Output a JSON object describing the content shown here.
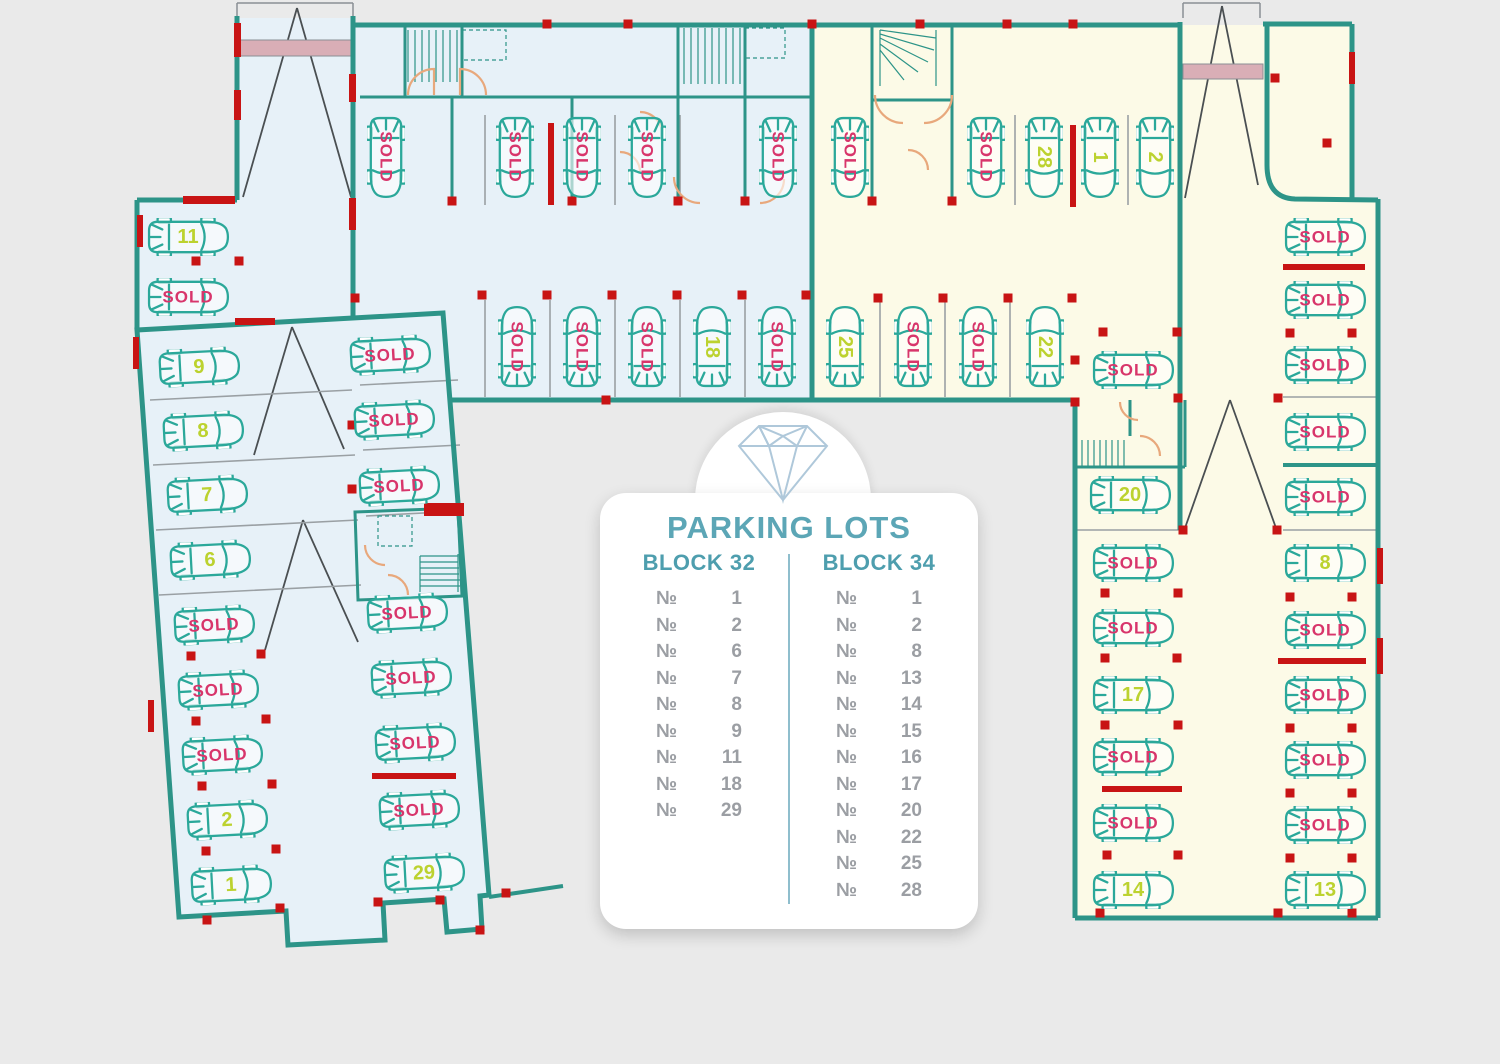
{
  "panel": {
    "logo_icon": "diamond-icon",
    "title": "PARKING LOTS",
    "numero_symbol": "№",
    "columns": [
      {
        "header": "BLOCK 32",
        "items": [
          "1",
          "2",
          "6",
          "7",
          "8",
          "9",
          "11",
          "18",
          "29"
        ]
      },
      {
        "header": "BLOCK 34",
        "items": [
          "1",
          "2",
          "8",
          "13",
          "14",
          "15",
          "16",
          "17",
          "20",
          "22",
          "25",
          "28"
        ]
      }
    ]
  },
  "labels": {
    "sold": "SOLD"
  },
  "colors": {
    "background": "#eaeaea",
    "block32_floor": "#e7f1f8",
    "block34_floor": "#fcfae7",
    "wall_teal": "#2d9488",
    "red": "#c81414",
    "pink_band": "#d9aeb6",
    "car_outline": "#2ba89a",
    "sold_text": "#d8356b",
    "number_text": "#bcd22f",
    "panel_title": "#5ca6b6",
    "panel_header": "#4e9eae",
    "panel_list": "#9b9ea3"
  },
  "cars": [
    {
      "block": 32,
      "x": 188,
      "y": 237,
      "a": 0,
      "label": "11",
      "sold": false
    },
    {
      "block": 32,
      "x": 188,
      "y": 297,
      "a": 0,
      "label": "SOLD",
      "sold": true
    },
    {
      "block": 32,
      "x": 199,
      "y": 367,
      "a": -3,
      "label": "9",
      "sold": false
    },
    {
      "block": 32,
      "x": 203,
      "y": 431,
      "a": -3,
      "label": "8",
      "sold": false
    },
    {
      "block": 32,
      "x": 207,
      "y": 495,
      "a": -3,
      "label": "7",
      "sold": false
    },
    {
      "block": 32,
      "x": 210,
      "y": 560,
      "a": -3,
      "label": "6",
      "sold": false
    },
    {
      "block": 32,
      "x": 214,
      "y": 625,
      "a": -3,
      "label": "SOLD",
      "sold": true
    },
    {
      "block": 32,
      "x": 218,
      "y": 690,
      "a": -3,
      "label": "SOLD",
      "sold": true
    },
    {
      "block": 32,
      "x": 222,
      "y": 755,
      "a": -3,
      "label": "SOLD",
      "sold": true
    },
    {
      "block": 32,
      "x": 227,
      "y": 820,
      "a": -3,
      "label": "2",
      "sold": false
    },
    {
      "block": 32,
      "x": 231,
      "y": 885,
      "a": -3,
      "label": "1",
      "sold": false
    },
    {
      "block": 32,
      "x": 390,
      "y": 355,
      "a": -3,
      "label": "SOLD",
      "sold": true
    },
    {
      "block": 32,
      "x": 394,
      "y": 420,
      "a": -3,
      "label": "SOLD",
      "sold": true
    },
    {
      "block": 32,
      "x": 399,
      "y": 486,
      "a": -3,
      "label": "SOLD",
      "sold": true
    },
    {
      "block": 32,
      "x": 407,
      "y": 613,
      "a": -3,
      "label": "SOLD",
      "sold": true
    },
    {
      "block": 32,
      "x": 411,
      "y": 678,
      "a": -3,
      "label": "SOLD",
      "sold": true
    },
    {
      "block": 32,
      "x": 415,
      "y": 743,
      "a": -3,
      "label": "SOLD",
      "sold": true
    },
    {
      "block": 32,
      "x": 419,
      "y": 810,
      "a": -3,
      "label": "SOLD",
      "sold": true
    },
    {
      "block": 32,
      "x": 424,
      "y": 873,
      "a": -3,
      "label": "29",
      "sold": false
    },
    {
      "block": 32,
      "x": 386,
      "y": 157,
      "a": 90,
      "label": "SOLD",
      "sold": true
    },
    {
      "block": 32,
      "x": 515,
      "y": 157,
      "a": 90,
      "label": "SOLD",
      "sold": true
    },
    {
      "block": 32,
      "x": 582,
      "y": 157,
      "a": 90,
      "label": "SOLD",
      "sold": true
    },
    {
      "block": 32,
      "x": 647,
      "y": 157,
      "a": 90,
      "label": "SOLD",
      "sold": true
    },
    {
      "block": 32,
      "x": 778,
      "y": 157,
      "a": 90,
      "label": "SOLD",
      "sold": true
    },
    {
      "block": 32,
      "x": 517,
      "y": 347,
      "a": -90,
      "label": "SOLD",
      "sold": true
    },
    {
      "block": 32,
      "x": 582,
      "y": 347,
      "a": -90,
      "label": "SOLD",
      "sold": true
    },
    {
      "block": 32,
      "x": 647,
      "y": 347,
      "a": -90,
      "label": "SOLD",
      "sold": true
    },
    {
      "block": 32,
      "x": 712,
      "y": 347,
      "a": -90,
      "label": "18",
      "sold": false
    },
    {
      "block": 32,
      "x": 777,
      "y": 347,
      "a": -90,
      "label": "SOLD",
      "sold": true
    },
    {
      "block": 34,
      "x": 850,
      "y": 157,
      "a": 90,
      "label": "SOLD",
      "sold": true
    },
    {
      "block": 34,
      "x": 986,
      "y": 157,
      "a": 90,
      "label": "SOLD",
      "sold": true
    },
    {
      "block": 34,
      "x": 1044,
      "y": 157,
      "a": 90,
      "label": "28",
      "sold": false
    },
    {
      "block": 34,
      "x": 1100,
      "y": 157,
      "a": 90,
      "label": "1",
      "sold": false
    },
    {
      "block": 34,
      "x": 1155,
      "y": 157,
      "a": 90,
      "label": "2",
      "sold": false
    },
    {
      "block": 34,
      "x": 845,
      "y": 347,
      "a": -90,
      "label": "25",
      "sold": false
    },
    {
      "block": 34,
      "x": 913,
      "y": 347,
      "a": -90,
      "label": "SOLD",
      "sold": true
    },
    {
      "block": 34,
      "x": 978,
      "y": 347,
      "a": -90,
      "label": "SOLD",
      "sold": true
    },
    {
      "block": 34,
      "x": 1045,
      "y": 347,
      "a": -90,
      "label": "22",
      "sold": false
    },
    {
      "block": 34,
      "x": 1133,
      "y": 370,
      "a": 0,
      "label": "SOLD",
      "sold": true
    },
    {
      "block": 34,
      "x": 1130,
      "y": 495,
      "a": 0,
      "label": "20",
      "sold": false
    },
    {
      "block": 34,
      "x": 1133,
      "y": 563,
      "a": 0,
      "label": "SOLD",
      "sold": true
    },
    {
      "block": 34,
      "x": 1133,
      "y": 628,
      "a": 0,
      "label": "SOLD",
      "sold": true
    },
    {
      "block": 34,
      "x": 1133,
      "y": 695,
      "a": 0,
      "label": "17",
      "sold": false
    },
    {
      "block": 34,
      "x": 1133,
      "y": 757,
      "a": 0,
      "label": "SOLD",
      "sold": true
    },
    {
      "block": 34,
      "x": 1133,
      "y": 823,
      "a": 0,
      "label": "SOLD",
      "sold": true
    },
    {
      "block": 34,
      "x": 1133,
      "y": 890,
      "a": 0,
      "label": "14",
      "sold": false
    },
    {
      "block": 34,
      "x": 1325,
      "y": 237,
      "a": 0,
      "label": "SOLD",
      "sold": true
    },
    {
      "block": 34,
      "x": 1325,
      "y": 300,
      "a": 0,
      "label": "SOLD",
      "sold": true
    },
    {
      "block": 34,
      "x": 1325,
      "y": 365,
      "a": 0,
      "label": "SOLD",
      "sold": true
    },
    {
      "block": 34,
      "x": 1325,
      "y": 432,
      "a": 0,
      "label": "SOLD",
      "sold": true
    },
    {
      "block": 34,
      "x": 1325,
      "y": 497,
      "a": 0,
      "label": "SOLD",
      "sold": true
    },
    {
      "block": 34,
      "x": 1325,
      "y": 563,
      "a": 0,
      "label": "8",
      "sold": false
    },
    {
      "block": 34,
      "x": 1325,
      "y": 630,
      "a": 0,
      "label": "SOLD",
      "sold": true
    },
    {
      "block": 34,
      "x": 1325,
      "y": 695,
      "a": 0,
      "label": "SOLD",
      "sold": true
    },
    {
      "block": 34,
      "x": 1325,
      "y": 760,
      "a": 0,
      "label": "SOLD",
      "sold": true
    },
    {
      "block": 34,
      "x": 1325,
      "y": 825,
      "a": 0,
      "label": "SOLD",
      "sold": true
    },
    {
      "block": 34,
      "x": 1325,
      "y": 890,
      "a": 0,
      "label": "13",
      "sold": false
    }
  ],
  "marks": {
    "dots": [
      [
        196,
        261
      ],
      [
        239,
        261
      ],
      [
        355,
        298
      ],
      [
        547,
        24
      ],
      [
        628,
        24
      ],
      [
        812,
        24
      ],
      [
        920,
        24
      ],
      [
        1007,
        24
      ],
      [
        1073,
        24
      ],
      [
        452,
        201
      ],
      [
        572,
        201
      ],
      [
        678,
        201
      ],
      [
        745,
        201
      ],
      [
        872,
        201
      ],
      [
        952,
        201
      ],
      [
        482,
        295
      ],
      [
        547,
        295
      ],
      [
        612,
        295
      ],
      [
        677,
        295
      ],
      [
        742,
        295
      ],
      [
        806,
        295
      ],
      [
        878,
        298
      ],
      [
        943,
        298
      ],
      [
        1008,
        298
      ],
      [
        1072,
        298
      ],
      [
        606,
        400
      ],
      [
        1275,
        78
      ],
      [
        1327,
        143
      ],
      [
        1178,
        398
      ],
      [
        1278,
        398
      ],
      [
        1183,
        530
      ],
      [
        1277,
        530
      ],
      [
        1103,
        332
      ],
      [
        1177,
        332
      ],
      [
        1105,
        593
      ],
      [
        1178,
        593
      ],
      [
        1105,
        658
      ],
      [
        1177,
        658
      ],
      [
        1105,
        725
      ],
      [
        1178,
        725
      ],
      [
        1107,
        855
      ],
      [
        1178,
        855
      ],
      [
        1290,
        333
      ],
      [
        1352,
        333
      ],
      [
        1290,
        597
      ],
      [
        1352,
        597
      ],
      [
        1290,
        728
      ],
      [
        1352,
        728
      ],
      [
        1290,
        793
      ],
      [
        1352,
        793
      ],
      [
        1290,
        858
      ],
      [
        1352,
        858
      ],
      [
        1100,
        913
      ],
      [
        1278,
        913
      ],
      [
        1352,
        913
      ],
      [
        207,
        920
      ],
      [
        280,
        908
      ],
      [
        378,
        902
      ],
      [
        440,
        900
      ],
      [
        480,
        930
      ],
      [
        506,
        893
      ],
      [
        191,
        656
      ],
      [
        261,
        654
      ],
      [
        196,
        721
      ],
      [
        266,
        719
      ],
      [
        202,
        786
      ],
      [
        272,
        784
      ],
      [
        206,
        851
      ],
      [
        276,
        849
      ],
      [
        352,
        425
      ],
      [
        352,
        489
      ],
      [
        1075,
        402
      ],
      [
        1075,
        360
      ]
    ],
    "bars": [
      [
        548,
        123,
        6,
        82
      ],
      [
        1070,
        125,
        6,
        82
      ],
      [
        1283,
        264,
        82,
        6
      ],
      [
        1278,
        658,
        88,
        6
      ],
      [
        1102,
        786,
        80,
        6
      ],
      [
        372,
        773,
        84,
        6
      ]
    ],
    "red_walls": [
      [
        137,
        215,
        6,
        32
      ],
      [
        183,
        196,
        52,
        8
      ],
      [
        234,
        23,
        7,
        34
      ],
      [
        234,
        90,
        7,
        30
      ],
      [
        349,
        74,
        7,
        28
      ],
      [
        349,
        198,
        7,
        32
      ],
      [
        133,
        337,
        6,
        32
      ],
      [
        148,
        700,
        6,
        32
      ],
      [
        1349,
        52,
        6,
        32
      ],
      [
        1377,
        548,
        6,
        36
      ],
      [
        1377,
        638,
        6,
        36
      ],
      [
        424,
        503,
        40,
        13
      ],
      [
        235,
        318,
        40,
        7
      ]
    ],
    "pink_bands": [
      [
        240,
        40,
        113,
        16
      ],
      [
        1183,
        64,
        80,
        15
      ]
    ]
  }
}
